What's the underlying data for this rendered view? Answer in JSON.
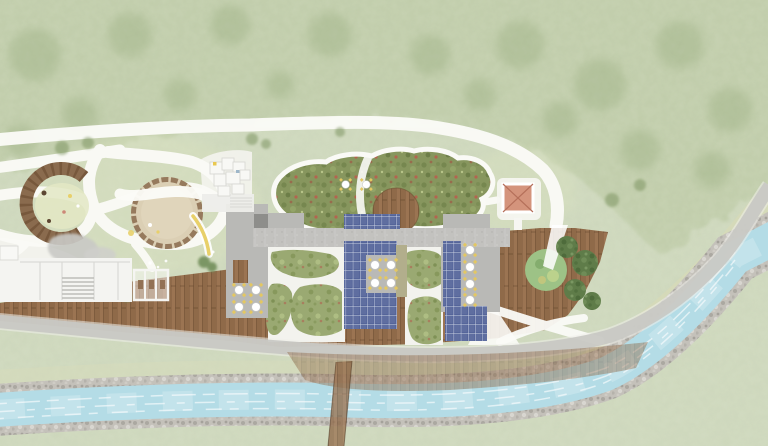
{
  "meta": {
    "title": "Landscape architecture site plan",
    "view": "top-down masterplan rendering",
    "canvas": {
      "width_px": 768,
      "height_px": 446
    }
  },
  "colors": {
    "grass_base": "#ced8bd",
    "canopy": "#b4c39a",
    "lawn_light": "#dde4bf",
    "path_white": "#fbfbf7",
    "plaza_white": "#f3f3ee",
    "road_gray": "#c8c8c4",
    "river_water": "#b4dce6",
    "river_bank": "#c4c1ba",
    "sand_strip": "#d8dab6",
    "wood_deck": "#9b7452",
    "solar_panel": "#55659a",
    "solar_grid": "#ccd3e3",
    "concrete_roof": "#c3c2bf",
    "gray_roof": "#b9b9b6",
    "dark_roof": "#8e8e8b",
    "olive_roof": "#b2ae8c",
    "green_roof": "#87965e",
    "green_roof_red": "#b2654f",
    "courtyard_green": "#9aa972",
    "pavilion_roof": "#d4947c",
    "pavilion_cross": "#b5705a",
    "sand_circle": "#dbcfb4",
    "wood_ring": "#8a6b4e",
    "tree_dark": "#5f7c49",
    "tree_circle": "#9dc286",
    "slide_yellow": "#e8d06a",
    "table_white": "#ffffff",
    "chair_yellow": "#e3c763",
    "white_building": "#f4f4f1",
    "boulder_gray": "#c9c9c5"
  },
  "features": [
    {
      "name": "forest-meadow",
      "desc": "mottled green tree canopy and open meadow"
    },
    {
      "name": "looping-footpaths",
      "desc": "white curving footpaths through the park"
    },
    {
      "name": "play-circle-wood-arc",
      "desc": "play circle edged by a wooden arc with benches"
    },
    {
      "name": "sand-play-circle",
      "desc": "round sand play circle crossed by a path"
    },
    {
      "name": "yellow-slide",
      "desc": "curved yellow slide"
    },
    {
      "name": "boulder-cluster",
      "desc": "gray boulder outcrop"
    },
    {
      "name": "cluster-building",
      "desc": "small white cluster building with stepped terrace"
    },
    {
      "name": "green-roof",
      "desc": "cloud-shaped vegetated sedum roof"
    },
    {
      "name": "roof-terrace-dome",
      "desc": "semicircular wooden roof terrace with two tables"
    },
    {
      "name": "solar-arrays",
      "desc": "rooftop photovoltaic panel arrays",
      "count": 4
    },
    {
      "name": "rooftop-tables",
      "desc": "round tables with four chairs each",
      "count": 14
    },
    {
      "name": "concrete-roof-band",
      "desc": "long gray concrete roof band"
    },
    {
      "name": "courtyard-planting",
      "desc": "organic planted beds between roof wings"
    },
    {
      "name": "timber-deck",
      "desc": "large timber deck terrace along the buildings"
    },
    {
      "name": "deck-tree-circle",
      "desc": "round green tree planter set in the deck"
    },
    {
      "name": "pavilion",
      "desc": "square pavilion with terracotta hip roof"
    },
    {
      "name": "white-service-building",
      "desc": "low white building with entry steps"
    },
    {
      "name": "deck-pergola",
      "desc": "three-bay pergola frame on the deck"
    },
    {
      "name": "access-road",
      "desc": "gray access road curving along the site to the upper right"
    },
    {
      "name": "cantilevered-deck",
      "desc": "translucent cantilevered deck over the river bank"
    },
    {
      "name": "timber-bridge",
      "desc": "narrow timber footbridge across the stream"
    },
    {
      "name": "stream",
      "desc": "rocky-banked stream with white-water texture"
    },
    {
      "name": "evergreen-trees",
      "desc": "dark evergreen shrubs along the deck edge"
    }
  ]
}
